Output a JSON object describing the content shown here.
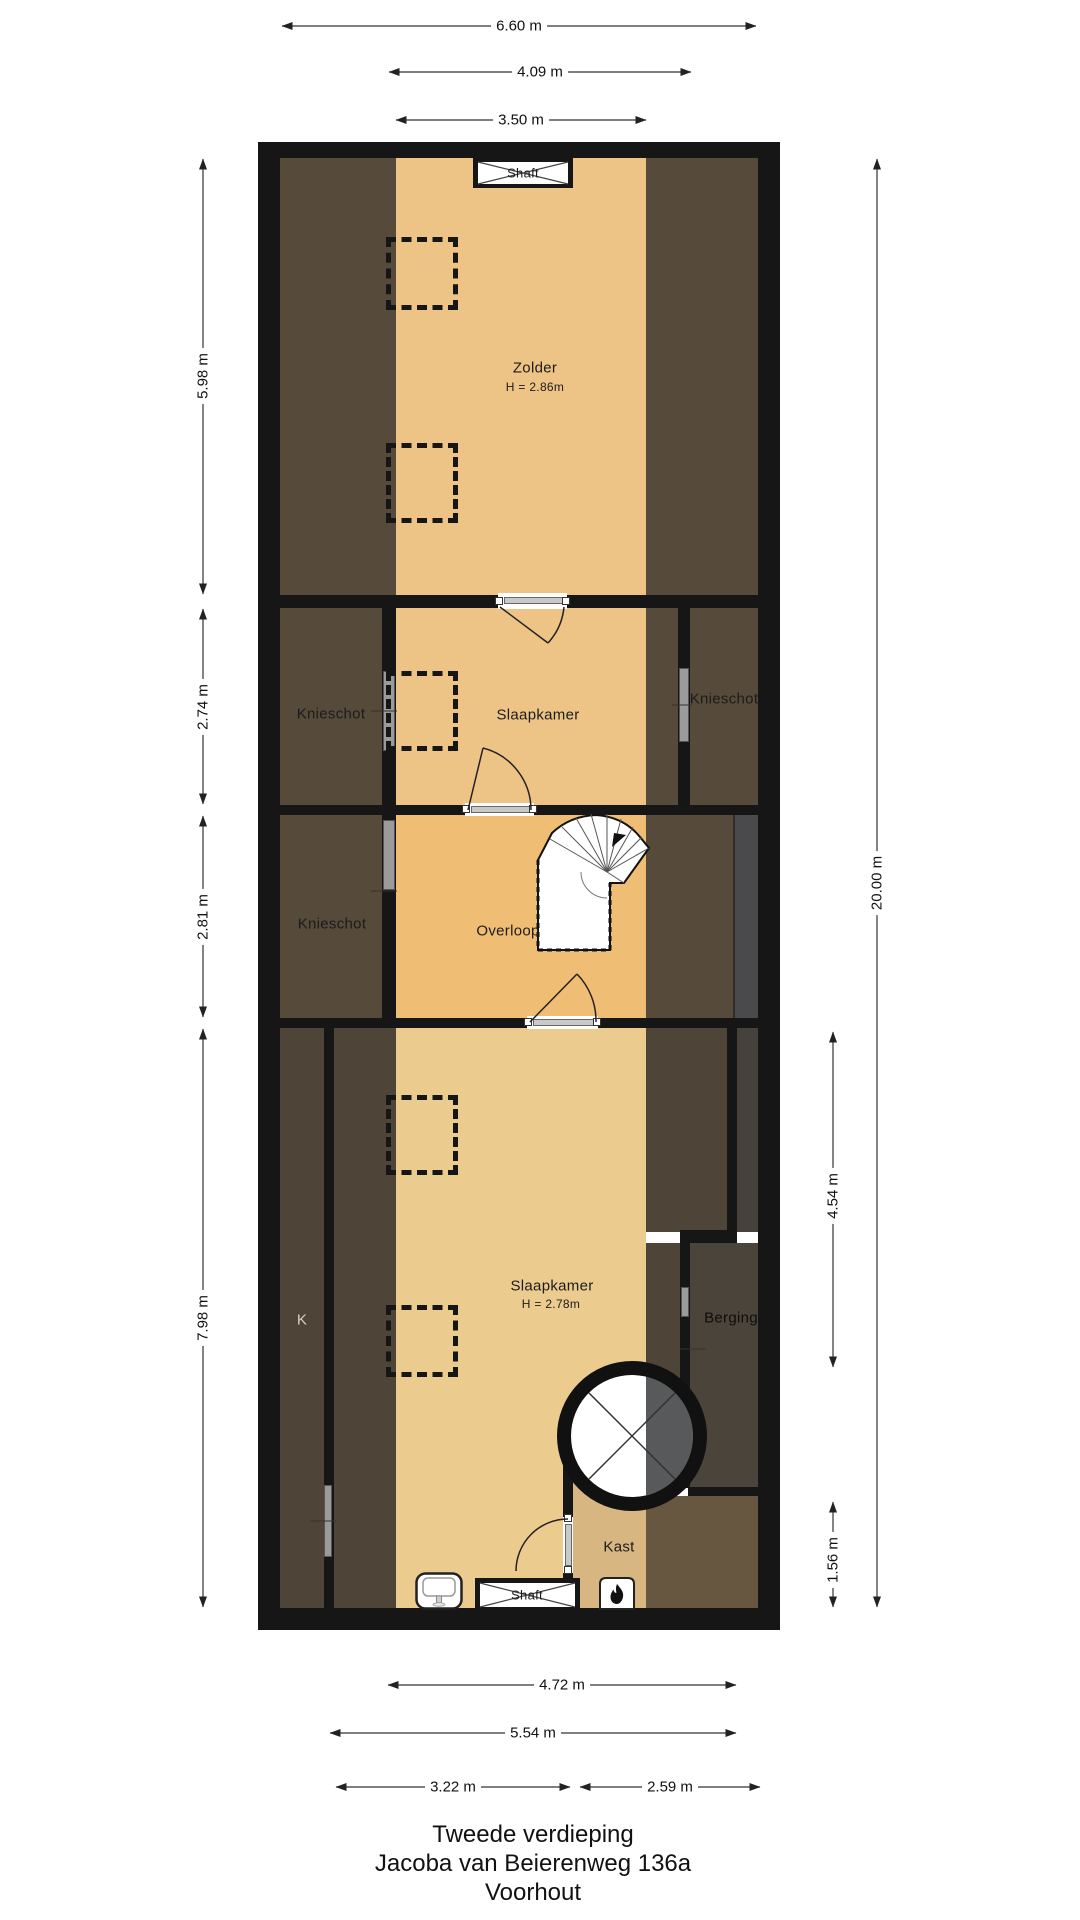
{
  "title": {
    "line1": "Tweede verdieping",
    "line2": "Jacoba van Beierenweg 136a",
    "line3": "Voorhout"
  },
  "rooms": {
    "zolder": {
      "name": "Zolder",
      "ceiling": "H = 2.86m"
    },
    "slaapkamer_mid": {
      "name": "Slaapkamer"
    },
    "overloop": {
      "name": "Overloop"
    },
    "slaapkamer_bottom": {
      "name": "Slaapkamer",
      "ceiling": "H = 2.78m"
    },
    "knieschot_mid_left": {
      "name": "Knieschot"
    },
    "knieschot_mid_right": {
      "name": "Knieschot"
    },
    "knieschot_overloop": {
      "name": "Knieschot"
    },
    "k_closet": {
      "name": "K"
    },
    "berging": {
      "name": "Berging"
    },
    "kast": {
      "name": "Kast"
    },
    "shaft_top": {
      "name": "Shaft"
    },
    "shaft_bottom": {
      "name": "Shaft"
    }
  },
  "dimensions": {
    "top": [
      "6.60 m",
      "4.09 m",
      "3.50 m"
    ],
    "bottom": [
      "4.72 m",
      "5.54 m",
      "3.22 m",
      "2.59 m"
    ],
    "left": [
      "5.98 m",
      "2.74 m",
      "2.81 m",
      "7.98 m"
    ],
    "right": [
      "20.00 m",
      "4.54 m",
      "1.56 m"
    ]
  },
  "icons": {
    "shaft_cross": "x-cross-icon",
    "spiral_stair_circle": "spiral-stair-circle-icon",
    "stairs": "winder-stairs-icon",
    "sink": "sink-icon",
    "fireplace": "fireplace-flame-icon",
    "skylight": "dashed-skylight-icon"
  },
  "colors": {
    "wall": "#161616",
    "floor_tan": "#edc486",
    "floor_tan_overloop": "#f0bd74",
    "floor_tan_bottom": "#eccb8f",
    "floor_tan_kast": "#d8b682",
    "roof_brown": "#564a3b",
    "roof_brown_dark": "#4e4538",
    "gray_strip": "#4a4a4c",
    "berging_brown": "#4a443a",
    "kast_brown": "#675740",
    "circle_gray": "#58595b",
    "window_gray": "#9b9b9b",
    "dimension_line": "#222222"
  }
}
